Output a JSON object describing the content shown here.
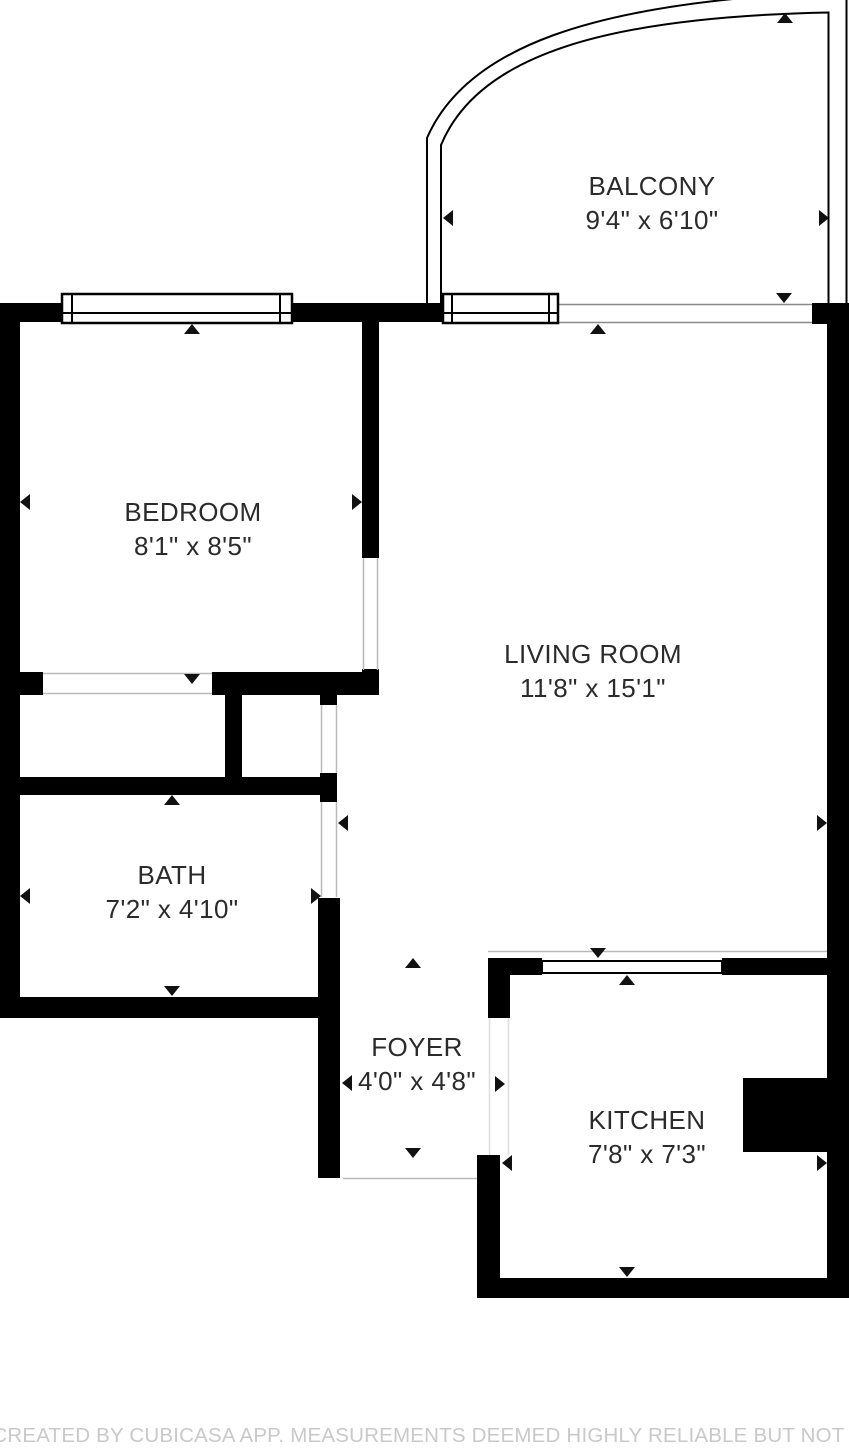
{
  "plan": {
    "rooms": [
      {
        "id": "balcony",
        "name": "BALCONY",
        "dims": "9'4\" x 6'10\""
      },
      {
        "id": "bedroom",
        "name": "BEDROOM",
        "dims": "8'1\" x 8'5\""
      },
      {
        "id": "living-room",
        "name": "LIVING ROOM",
        "dims": "11'8\" x 15'1\""
      },
      {
        "id": "bath",
        "name": "BATH",
        "dims": "7'2\" x 4'10\""
      },
      {
        "id": "foyer",
        "name": "FOYER",
        "dims": "4'0\" x 4'8\""
      },
      {
        "id": "kitchen",
        "name": "KITCHEN",
        "dims": "7'8\" x 7'3\""
      }
    ],
    "footer": "FLOOR PLAN CREATED BY CUBICASA APP. MEASUREMENTS DEEMED HIGHLY RELIABLE BUT NOT GUARANTEED",
    "colors": {
      "wall": "#000000",
      "room_text": "#2b2b2b",
      "footer_text": "#c9c9c9",
      "background": "#ffffff",
      "opening_line": "#b9b9b9"
    }
  }
}
